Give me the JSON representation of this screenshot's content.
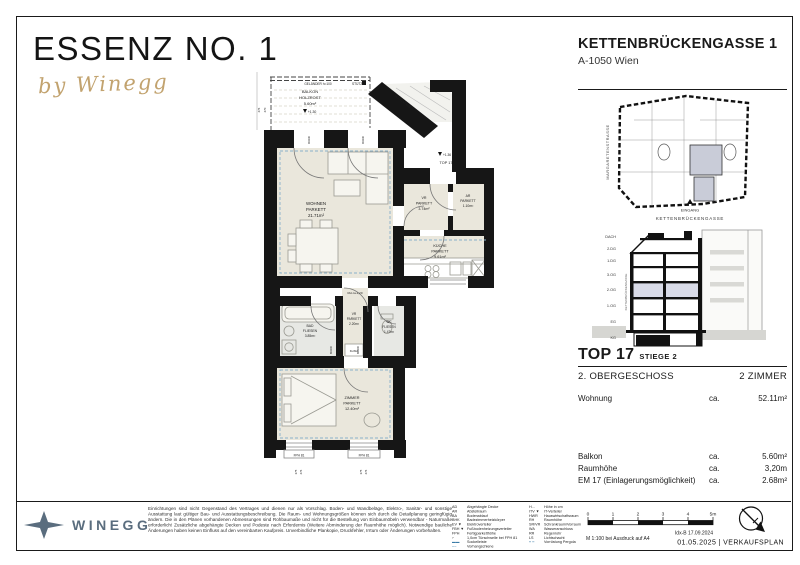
{
  "header": {
    "brand_title": "ESSENZ NO. 1",
    "brand_sub": "by Winegg",
    "address_title": "KETTENBRÜCKENGASSE 1",
    "address_sub": "A-1050 Wien"
  },
  "site_plan": {
    "street_left": "MARGARETENSTRASSE",
    "entrance_label": "EINGANG",
    "street_bottom": "KETTENBRÜCKENGASSE"
  },
  "section": {
    "street_label": "KETTENBRÜCKENGASSE",
    "levels": [
      "DACH",
      "2.DG",
      "1.DG",
      "3.OG",
      "2.OG",
      "1.OG",
      "EG",
      "KG"
    ]
  },
  "info": {
    "top_label": "TOP 17",
    "stiege": "STIEGE 2",
    "floor": "2. OBERGESCHOSS",
    "rooms_count": "2 ZIMMER",
    "rows": [
      {
        "label": "Wohnung",
        "ca": "ca.",
        "value": "52.11m²"
      },
      {
        "label": "Balkon",
        "ca": "ca.",
        "value": "5.60m²"
      },
      {
        "label": "Raumhöhe",
        "ca": "ca.",
        "value": "3,20m"
      },
      {
        "label": "EM 17 (Einlagerungsmöglichkeit)",
        "ca": "ca.",
        "value": "2.68m²"
      }
    ]
  },
  "plan": {
    "balcony": {
      "l1": "BALKON",
      "l2": "HOLZROST",
      "l3": "5.60m²",
      "level": "+1.30"
    },
    "railing_label": "GELÄNDER h=100",
    "stuetze_label": "STÜTZE",
    "entry": {
      "level": "+1.36",
      "top": "TOP 17"
    },
    "stair_note": "16 STG 17,6/28",
    "rh_note": "RH ca.2,20",
    "klima_label": "KLIMA",
    "fph_label": "FPH 81",
    "rooms": {
      "wohnen": {
        "l1": "WOHNEN",
        "l2": "PARKETT",
        "l3": "21.71m²"
      },
      "vr1": {
        "l1": "VR",
        "l2": "PARKETT",
        "l3": "3.74m²"
      },
      "ar": {
        "l1": "AR",
        "l2": "PARKETT",
        "l3": "1.10m²"
      },
      "kueche": {
        "l1": "KÜCHE",
        "l2": "PARKETT",
        "l3": "9.61m²"
      },
      "vr2": {
        "l1": "VR",
        "l2": "PARKETT",
        "l3": "2.20m²"
      },
      "bad": {
        "l1": "BAD",
        "l2": "FLIESEN",
        "l3": "3.85m²"
      },
      "wc": {
        "l1": "WC",
        "l2": "FLIESEN",
        "l3": "1.47m²"
      },
      "zimmer": {
        "l1": "ZIMMER",
        "l2": "PARKETT",
        "l3": "12.40m²"
      }
    },
    "dims": {
      "door_a": "90/230",
      "door_b": "80/200",
      "win_a": "375",
      "win_b": "276",
      "strip_a": "276",
      "strip_b": "270"
    }
  },
  "footer": {
    "brand": "WINEGG",
    "legal": "Einrichtungen sind nicht Gegenstand des Vertrages und dienen nur als Vorschlag. Boden- und Wandbeläge, Elektro-, Sanitär- und sonstige Ausstattung laut gültiger Bau- und Ausstattungsbeschreibung. Die Raum- und Wohnungsgrößen können sich durch die Detailplanung geringfügig ändern. Die in den Plänen vorhandenen Abmessungen sind Rohbaumaße und nicht für die Bestellung von Einbaumöbeln verwendbar - Naturmaße erforderlich! Zusätzliche abgehängte Decken und Podeste nach Erfordernis (Weitere Abminderung der Raumhöhe möglich). Notwendige bauliche Änderungen haben keinen Einfluss auf den vereinbarten Kaufpreis. Unverbindliche Plankopie, Druckfehler, Irrtum oder Änderungen vorbehalten.",
    "legend_col1": [
      {
        "abbr": "AD",
        "label": "Abgehängte Decke"
      },
      {
        "abbr": "AR",
        "label": "Abstellraum"
      },
      {
        "abbr": "BA",
        "label": "Bodenablauf"
      },
      {
        "abbr": "BHK",
        "label": "Badezimmerheizkörper"
      },
      {
        "abbr": "EV ▼",
        "label": "Elektroverteiler"
      },
      {
        "abbr": "FBH ▼",
        "label": "Fußbodenheizungsverteiler"
      },
      {
        "abbr": "FPH",
        "label": "Fertigparketthöhe"
      },
      {
        "abbr": "⌐",
        "label": "1,0cm Türschwelle bei FPH 81"
      },
      {
        "abbr": "▬▬",
        "label": "Sockelleiste"
      },
      {
        "abbr": "╌╌",
        "label": "Vorhangschiene"
      }
    ],
    "legend_col2": [
      {
        "abbr": "H…",
        "label": "Höhe in cm"
      },
      {
        "abbr": "ITV ▼",
        "label": "IT-Verteiler"
      },
      {
        "abbr": "HWR",
        "label": "Hauswirtschaftsraum"
      },
      {
        "abbr": "RH",
        "label": "Raumhöhe"
      },
      {
        "abbr": "SR/VR",
        "label": "Schrankraum/Vorraum"
      },
      {
        "abbr": "WA",
        "label": "Wasseranschluss"
      },
      {
        "abbr": "RR",
        "label": "Regenrohr"
      },
      {
        "abbr": "LS",
        "label": "Lichtschacht"
      },
      {
        "abbr": "╍ ╍",
        "label": "Vorrüstung Pergola"
      }
    ],
    "scale_ticks": [
      "0",
      "1",
      "2",
      "3",
      "4",
      "5m"
    ],
    "scale_note": "M 1:100 bei Ausdruck auf A4",
    "index_note": "Idx-B 17.09.2024",
    "date_plan": "01.05.2025  |  VERKAUFSPLAN"
  },
  "colors": {
    "accent_gold": "#c2a36f",
    "brand_slate": "#5a6d7e",
    "floor_beige": "#eae7dc",
    "tile_gray": "#e7e8e4",
    "highlight_lavender": "#d9dbe8",
    "highlight_gray": "#c9ccd8",
    "dash_blue": "#8ab1ca"
  }
}
